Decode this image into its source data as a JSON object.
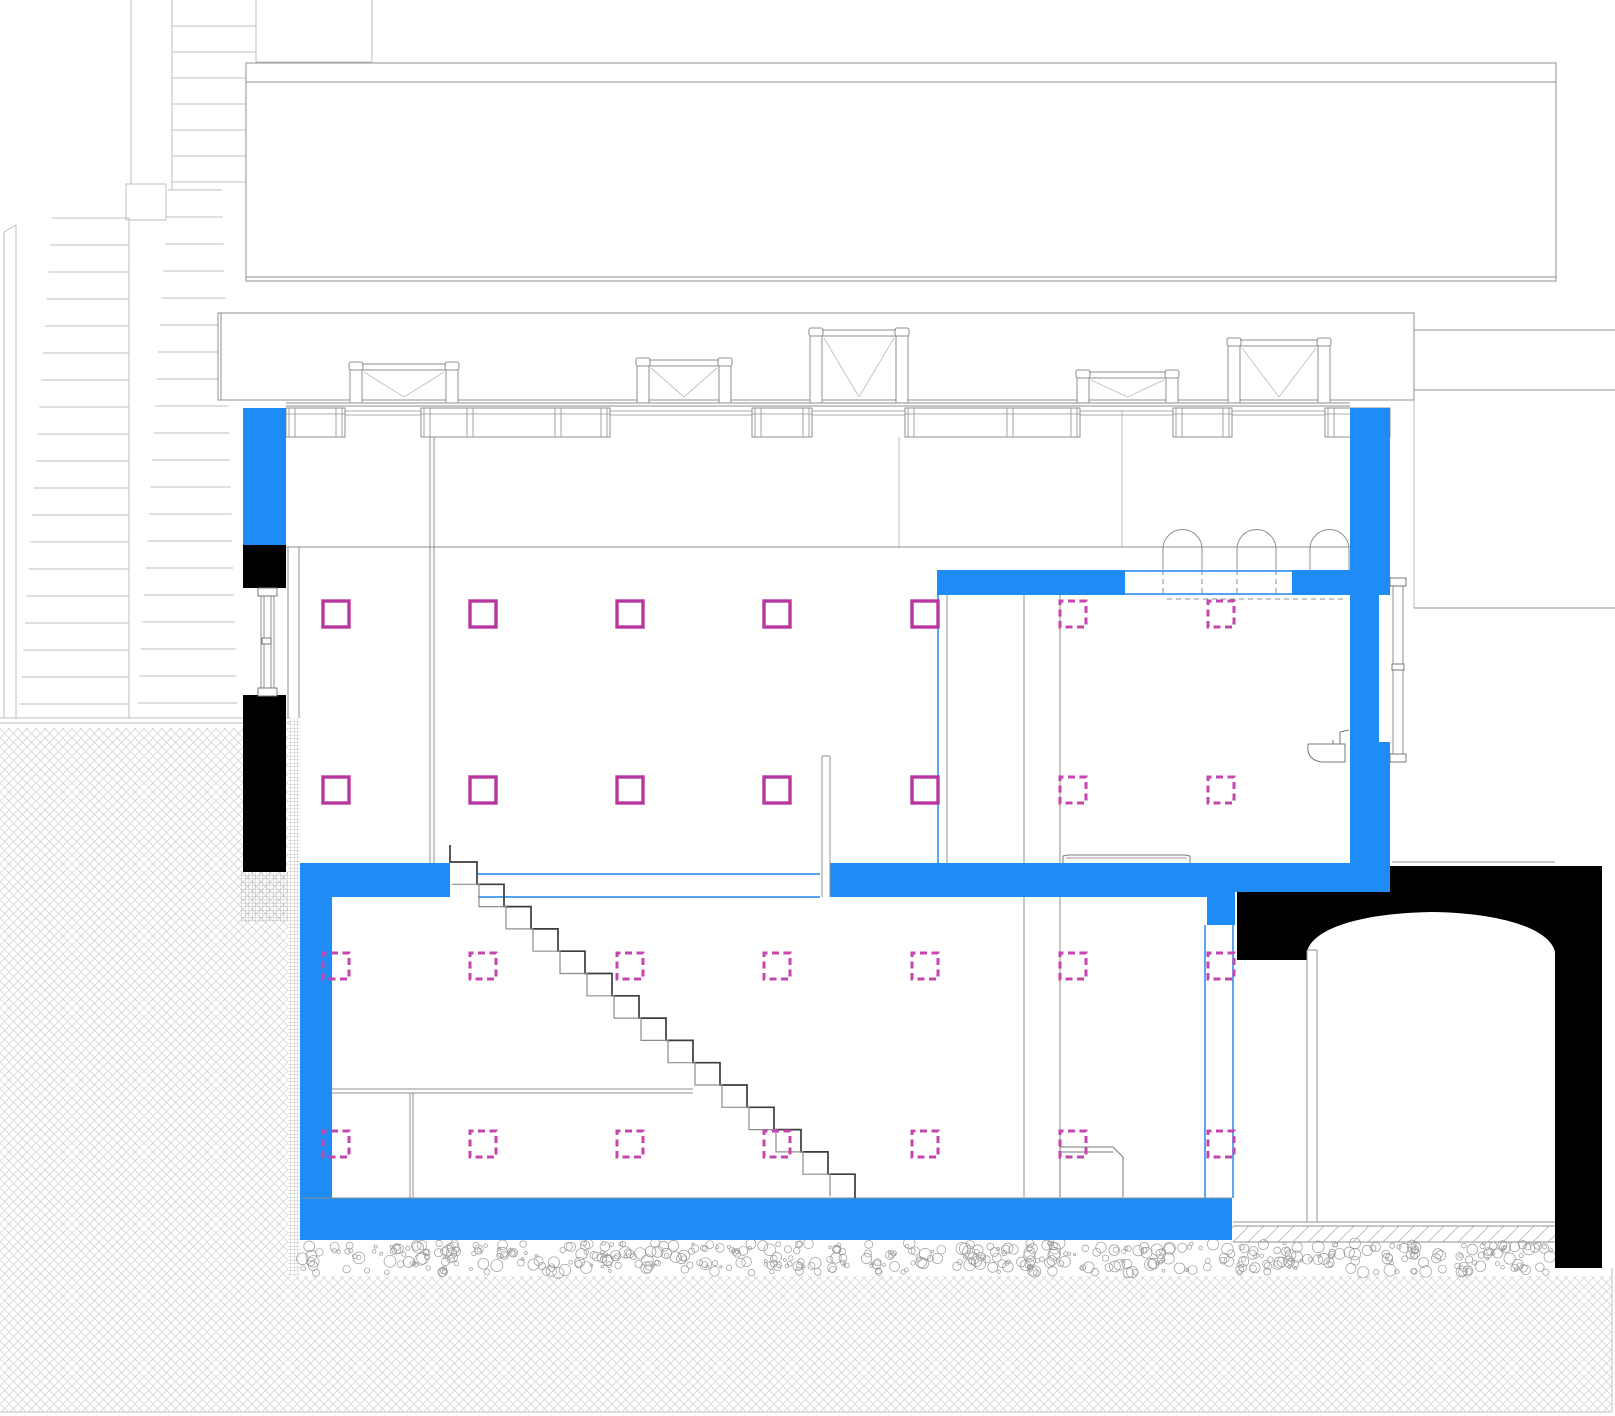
{
  "canvas": {
    "width": 1615,
    "height": 1416,
    "background": "#ffffff"
  },
  "palette": {
    "blue_fill": "#1F8CF5",
    "blue_line": "#3D97F2",
    "black_fill": "#000000",
    "magenta_solid": "#B8379F",
    "magenta_dashed": "#C446AC",
    "gray_line": "#8f8f8f",
    "gray_mid": "#777777",
    "gray_light": "#bfbfbf",
    "stair_dark": "#3c3c3c",
    "stair_light": "#8d8d8d",
    "hatch_earth": "#cfcfcf",
    "hatch_gravel": "#9a9a9a",
    "hatch_screed": "#b5b5b5",
    "hatch_mesh": "#8a8a8a"
  },
  "drawing": {
    "light_lines": [
      [
        131,
        0,
        131,
        184
      ],
      [
        172,
        0,
        172,
        190
      ],
      [
        256,
        0,
        256,
        64
      ],
      [
        372,
        0,
        372,
        62
      ],
      [
        256,
        62,
        372,
        62
      ],
      [
        129,
        218,
        129,
        718
      ],
      [
        4,
        232,
        4,
        718
      ],
      [
        16,
        225,
        16,
        718
      ],
      [
        4,
        232,
        16,
        225
      ],
      [
        0,
        718,
        290,
        718
      ],
      [
        0,
        723,
        290,
        723
      ],
      [
        899,
        437,
        899,
        548
      ],
      [
        1122,
        410,
        1122,
        547
      ],
      [
        1414,
        390,
        1414,
        608
      ],
      [
        0,
        1412,
        1612,
        1412
      ],
      [
        1612,
        1268,
        1612,
        1412
      ]
    ],
    "light_rects": [
      [
        126,
        184,
        40,
        36
      ]
    ],
    "flights": [
      {
        "y0": 26,
        "n": 7,
        "step": 26,
        "x1": 172,
        "x2": 256,
        "dx1": 0,
        "dx2": 0
      },
      {
        "y0": 190,
        "n": 20,
        "step": 27,
        "x1": 168,
        "x2": 222,
        "dx1": -1.6,
        "dx2": 0.8
      },
      {
        "y0": 218,
        "n": 19,
        "step": 27,
        "x1": 52,
        "x2": 129,
        "dx1": -1.8,
        "dx2": 0
      }
    ],
    "outline_rects": [
      [
        246,
        63,
        1310,
        19
      ],
      [
        246,
        82,
        1310,
        199
      ],
      [
        218,
        313,
        1196,
        87
      ],
      [
        1414,
        330,
        202,
        60
      ]
    ],
    "gray_lines": [
      [
        246,
        277,
        1556,
        277
      ],
      [
        221,
        313,
        221,
        400
      ],
      [
        286,
        403,
        1350,
        403
      ],
      [
        286,
        406,
        1350,
        406
      ],
      [
        286,
        547,
        1350,
        547
      ],
      [
        1392,
        862,
        1555,
        862
      ],
      [
        1414,
        608,
        1615,
        608
      ],
      [
        288,
        547,
        288,
        718
      ],
      [
        299,
        547,
        299,
        718
      ],
      [
        430,
        437,
        430,
        863
      ],
      [
        434,
        437,
        434,
        863
      ],
      [
        822,
        756,
        822,
        897
      ],
      [
        830,
        756,
        830,
        897
      ],
      [
        822,
        756,
        830,
        756
      ],
      [
        947,
        595,
        947,
        863
      ],
      [
        1024,
        595,
        1024,
        863
      ],
      [
        1060,
        595,
        1060,
        863
      ],
      [
        1024,
        897,
        1024,
        1197
      ],
      [
        1060,
        897,
        1060,
        1197
      ],
      [
        332,
        1089,
        693,
        1089
      ],
      [
        332,
        1093,
        693,
        1093
      ],
      [
        410,
        1093,
        410,
        1198
      ],
      [
        413,
        1093,
        413,
        1198
      ],
      [
        261,
        592,
        261,
        690
      ],
      [
        264,
        592,
        264,
        690
      ],
      [
        271,
        592,
        271,
        690
      ],
      [
        274,
        592,
        274,
        690
      ],
      [
        1393,
        578,
        1393,
        762
      ],
      [
        1403,
        578,
        1403,
        762
      ],
      [
        1307,
        950,
        1307,
        1222
      ],
      [
        1317,
        950,
        1317,
        1222
      ],
      [
        1307,
        950,
        1317,
        950
      ],
      [
        1233,
        1222,
        1555,
        1222
      ],
      [
        1233,
        1226,
        1555,
        1226
      ],
      [
        1233,
        1242,
        1555,
        1242
      ],
      [
        302,
        1198,
        1232,
        1198
      ]
    ],
    "gray_outline_rects": [
      [
        258,
        588,
        19,
        8
      ],
      [
        258,
        688,
        19,
        8
      ],
      [
        262,
        638,
        9,
        6
      ],
      [
        1390,
        578,
        16,
        8
      ],
      [
        1390,
        754,
        16,
        8
      ],
      [
        1392,
        664,
        12,
        6
      ]
    ],
    "dashed_lines": [
      [
        1163,
        570,
        1163,
        597
      ],
      [
        1202,
        570,
        1202,
        597
      ],
      [
        1237,
        570,
        1237,
        597
      ],
      [
        1276,
        570,
        1276,
        597
      ],
      [
        1167,
        599,
        1347,
        599
      ]
    ],
    "hatch_rects": [
      {
        "x": 0,
        "y": 728,
        "w": 288,
        "h": 684,
        "pattern": "earth"
      },
      {
        "x": 288,
        "y": 1276,
        "w": 1324,
        "h": 136,
        "pattern": "earth"
      },
      {
        "x": 1232,
        "y": 1226,
        "w": 323,
        "h": 16,
        "pattern": "screed"
      },
      {
        "x": 288,
        "y": 718,
        "w": 12,
        "h": 558,
        "pattern": "mesh"
      },
      {
        "x": 241,
        "y": 872,
        "w": 47,
        "h": 50,
        "pattern": "mesh"
      }
    ],
    "gravel": {
      "x": 302,
      "y": 1243,
      "w": 1251,
      "h": 30,
      "count": 520,
      "rmin": 1.2,
      "rmax": 6,
      "seed": 42
    },
    "black_rects": [
      [
        243,
        545,
        43,
        43
      ],
      [
        243,
        695,
        43,
        177
      ]
    ],
    "vault_path": "M1237,892 H1390 V866 H1602 V1268 H1555 V952 C1550,929 1502,913 1432,912 C1360,913 1312,929 1307,952 V960 H1237 Z",
    "blue_rects": [
      [
        243,
        408,
        43,
        137
      ],
      [
        1350,
        408,
        40,
        484
      ],
      [
        937,
        570,
        188,
        25
      ],
      [
        1292,
        570,
        58,
        25
      ],
      [
        300,
        863,
        150,
        34
      ],
      [
        830,
        863,
        377,
        34
      ],
      [
        1207,
        863,
        28,
        62
      ],
      [
        1235,
        863,
        155,
        29
      ],
      [
        300,
        897,
        32,
        301
      ],
      [
        300,
        1198,
        932,
        42
      ]
    ],
    "white_rects": [
      [
        1379,
        595,
        11,
        147
      ]
    ],
    "blue_lines": [
      [
        478,
        874,
        820,
        874
      ],
      [
        478,
        897,
        820,
        897
      ],
      [
        1125,
        571,
        1292,
        571
      ],
      [
        1125,
        594,
        1292,
        594
      ],
      [
        938,
        595,
        938,
        863
      ],
      [
        1205,
        925,
        1205,
        1198
      ],
      [
        1233,
        925,
        1233,
        1198
      ]
    ],
    "skylights": {
      "base": 403,
      "items": [
        {
          "x": 350,
          "w": 108,
          "top": 362
        },
        {
          "x": 637,
          "w": 94,
          "top": 358
        },
        {
          "x": 810,
          "w": 98,
          "top": 328
        },
        {
          "x": 1077,
          "w": 101,
          "top": 370
        },
        {
          "x": 1228,
          "w": 102,
          "top": 338
        }
      ]
    },
    "panels": {
      "y1": 408,
      "y2": 437,
      "mid": 414,
      "items": [
        {
          "x1": 286,
          "x2": 345,
          "mullions": []
        },
        {
          "x1": 421,
          "x2": 610,
          "mullions": [
            470,
            558
          ]
        },
        {
          "x1": 752,
          "x2": 812,
          "mullions": []
        },
        {
          "x1": 905,
          "x2": 1080,
          "mullions": [
            1010
          ]
        },
        {
          "x1": 1173,
          "x2": 1232,
          "mullions": []
        },
        {
          "x1": 1325,
          "x2": 1390,
          "mullions": []
        }
      ],
      "connectors": [
        [
          345,
          421
        ],
        [
          610,
          752
        ],
        [
          812,
          905
        ],
        [
          1080,
          1173
        ],
        [
          1232,
          1325
        ]
      ]
    },
    "arches": {
      "base": 570,
      "spring": 549,
      "items": [
        [
          1163,
          1202
        ],
        [
          1237,
          1276
        ],
        [
          1310,
          1349
        ]
      ]
    },
    "stair": {
      "x": 450,
      "y": 862,
      "tread": 27,
      "rise": 22.3,
      "n": 15,
      "floor": 1198,
      "topcap": 845
    },
    "counter_path": "M1060,1197 L1060,1147 L1113,1147 L1123,1157 L1123,1197",
    "counter_line": [
      1060,
      1152,
      1113,
      1152
    ],
    "tray_path": "M1063,863 L1063,856 L1068,855 L1185,855 L1190,856 L1190,863",
    "tray_line": [
      1066,
      858,
      1187,
      858
    ],
    "sink_path": "M1308,744 L1345,744 L1345,762 L1322,762 Q1306,760 1308,744 Z",
    "sink_faucet": [
      [
        1340,
        744,
        1340,
        732
      ],
      [
        1340,
        732,
        1349,
        730
      ],
      [
        1333,
        744,
        1333,
        740
      ]
    ],
    "squares": {
      "size": 26,
      "solid": {
        "cols": [
          323,
          470,
          617,
          764,
          912
        ],
        "rows": [
          601,
          777
        ]
      },
      "dashed": [
        {
          "cols": [
            323,
            470,
            617,
            764,
            912,
            1060,
            1208
          ],
          "rows": [
            953,
            1131
          ]
        },
        {
          "cols": [
            1060,
            1208
          ],
          "rows": [
            601,
            777
          ]
        }
      ]
    }
  }
}
